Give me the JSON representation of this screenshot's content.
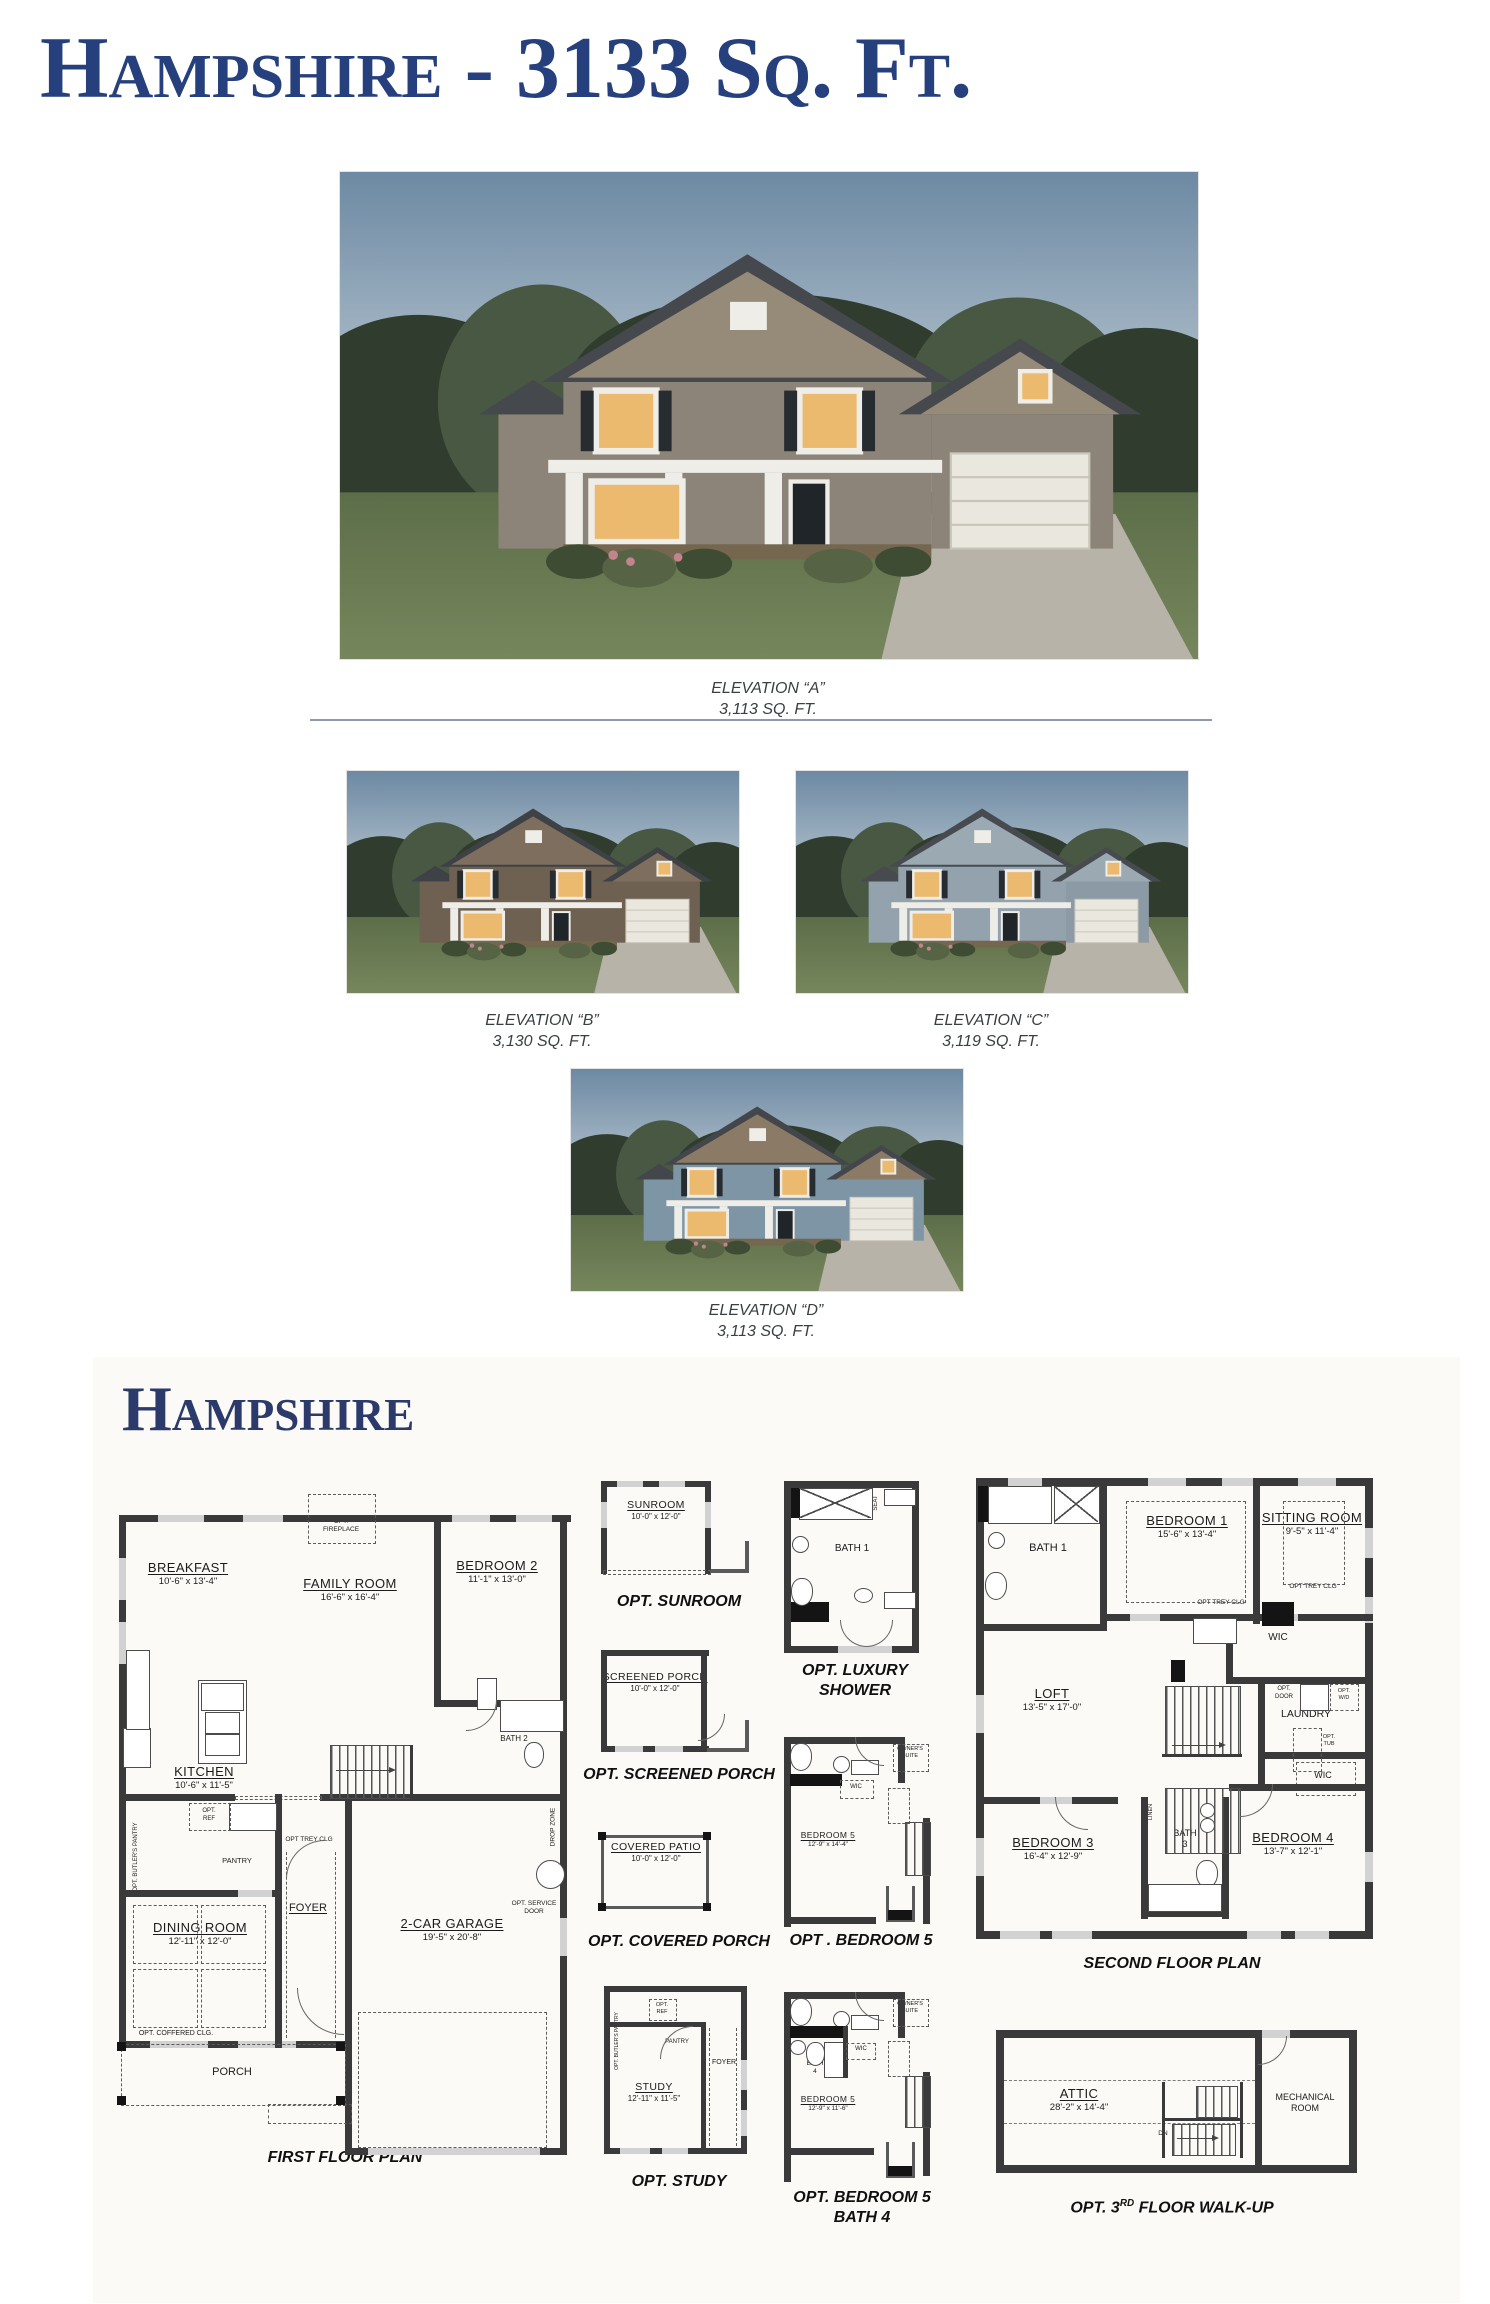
{
  "title": "Hampshire - 3133 Sq. Ft.",
  "section_header": "Hampshire",
  "elevations": {
    "a": {
      "line1": "ELEVATION “A”",
      "line2": "3,113 SQ. FT."
    },
    "b": {
      "line1": "ELEVATION “B”",
      "line2": "3,130 SQ. FT."
    },
    "c": {
      "line1": "ELEVATION “C”",
      "line2": "3,119 SQ. FT."
    },
    "d": {
      "line1": "ELEVATION “D”",
      "line2": "3,113 SQ. FT."
    }
  },
  "ff": {
    "caption": "FIRST FLOOR PLAN",
    "breakfast": {
      "name": "BREAKFAST",
      "dims": "10'-6\" x 13'-4\""
    },
    "family": {
      "name": "FAMILY ROOM",
      "dims": "16'-6\" x 16'-4\""
    },
    "bedroom2": {
      "name": "BEDROOM 2",
      "dims": "11'-1\" x 13'-0\""
    },
    "kitchen": {
      "name": "KITCHEN",
      "dims": "10'-6\" x 11'-5\""
    },
    "dining": {
      "name": "DINING ROOM",
      "dims": "12'-11\" x 12'-0\""
    },
    "garage": {
      "name": "2-CAR GARAGE",
      "dims": "19'-5\" x 20'-8\""
    },
    "foyer": "FOYER",
    "porch": "PORCH",
    "pantry": "PANTRY",
    "bath2": "BATH 2",
    "opt_fireplace": "OPT. FIREPLACE",
    "opt_ref": "OPT. REF",
    "opt_butlers": "OPT. BUTLER'S PANTRY",
    "opt_trey": "OPT TREY CLG",
    "opt_coffered": "OPT. COFFERED CLG.",
    "drop_zone": "DROP ZONE",
    "wh": "WH",
    "opt_service": "OPT. SERVICE DOOR",
    "linen": "LINEN",
    "dw": "DW"
  },
  "mid": {
    "sunroom": {
      "name": "SUNROOM",
      "dims": "10'-0\" x 12'-0\"",
      "caption": "OPT. SUNROOM"
    },
    "screened": {
      "name": "SCREENED PORCH",
      "dims": "10'-0\" x 12'-0\"",
      "caption": "OPT. SCREENED PORCH"
    },
    "patio": {
      "name": "COVERED PATIO",
      "dims": "10'-0\" x 12'-0\"",
      "caption": "OPT. COVERED PORCH"
    },
    "study": {
      "name": "STUDY",
      "dims": "12'-11\" x 11'-5\"",
      "caption": "OPT. STUDY",
      "foyer": "FOYER",
      "pantry": "PANTRY",
      "opt_ref": "OPT. REF",
      "opt_butlers": "OPT. BUTLER'S PANTRY"
    }
  },
  "rt": {
    "lux": {
      "bath": "BATH 1",
      "seat": "SEAT",
      "linen1": "LINEN",
      "linen2": "LINEN",
      "cap1": "OPT. LUXURY",
      "cap2": "SHOWER"
    },
    "bed5": {
      "name": "BEDROOM 5",
      "dims": "12'-9\" x 14'-4\"",
      "wic": "WIC",
      "linen": "LINEN",
      "owners1": "OWNER'S",
      "owners2": "SUITE",
      "caption": "OPT . BEDROOM 5"
    },
    "bed5b": {
      "name": "BEDROOM 5",
      "dims": "12'-9\" x 11'-6\"",
      "bath1": "BATH",
      "bath2": "4",
      "wic": "WIC",
      "linen": "LINEN",
      "owners1": "OWNER'S",
      "owners2": "SUITE",
      "cap1": "OPT. BEDROOM 5",
      "cap2": "BATH 4"
    }
  },
  "sf": {
    "caption": "SECOND FLOOR PLAN",
    "bath1": "BATH 1",
    "bedroom1": {
      "name": "BEDROOM 1",
      "dims": "15'-6\" x 13'-4\""
    },
    "sitting": {
      "name": "SITTING ROOM",
      "dims": "9'-5\" x 11'-4\""
    },
    "loft": {
      "name": "LOFT",
      "dims": "13'-5\" x 17'-0\""
    },
    "bedroom3": {
      "name": "BEDROOM 3",
      "dims": "16'-4\" x 12'-9\""
    },
    "bedroom4": {
      "name": "BEDROOM 4",
      "dims": "13'-7\" x 12'-1\""
    },
    "bath3_1": "BATH",
    "bath3_2": "3",
    "laundry": "LAUNDRY",
    "wic": "WIC",
    "wic2": "WIC",
    "linen": "LINEN",
    "linen2": "LINEN",
    "opt_trey": "OPT TREY CLG",
    "opt_trey2": "OPT TREY CLG",
    "opt_door": "OPT. DOOR",
    "opt_wd": "OPT. W/D",
    "opt_tub": "OPT. TUB"
  },
  "tf": {
    "attic": {
      "name": "ATTIC",
      "dims": "28'-2\" x 14'-4\""
    },
    "mech1": "MECHANICAL",
    "mech2": "ROOM",
    "dn": "DN",
    "cap_pre": "OPT. 3",
    "cap_sup": "RD",
    "cap_post": " FLOOR WALK-UP"
  }
}
